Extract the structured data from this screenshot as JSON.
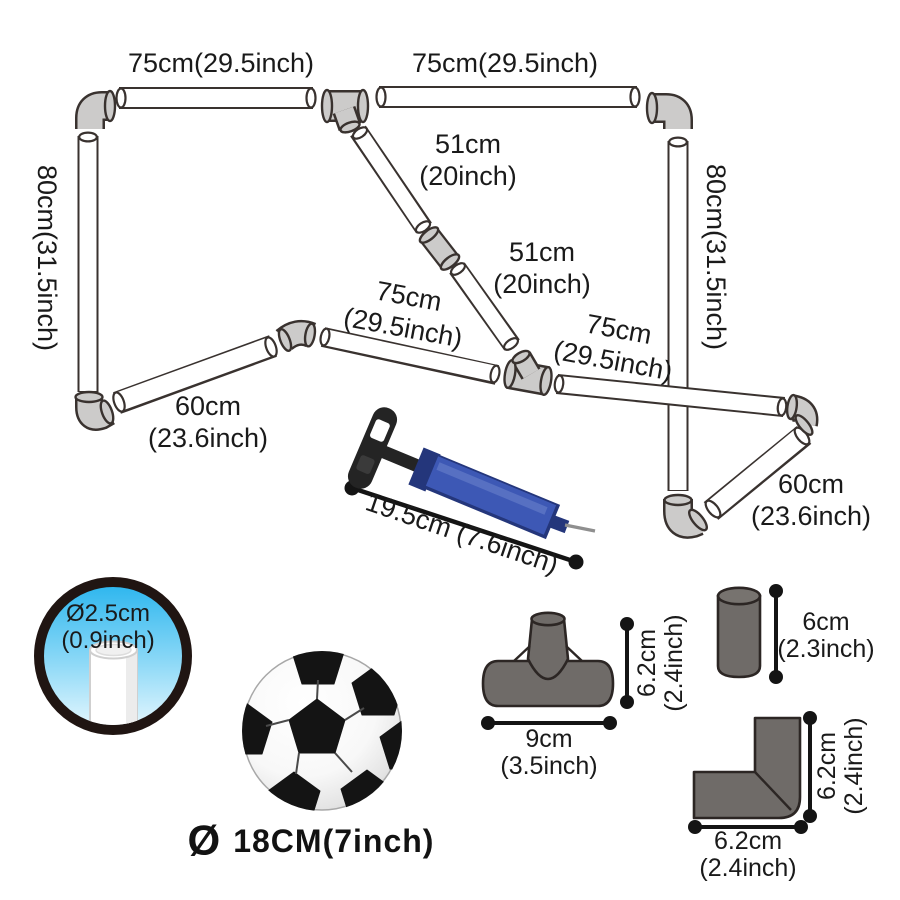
{
  "colors": {
    "pipe_outline": "#39322f",
    "pipe_fill": "#ffffff",
    "frame_connector_gray": "#cccbca",
    "part_gray": "#6f6b68",
    "part_outline": "#2c2624",
    "pump_blue": "#3d58b5",
    "pump_dark_blue": "#24367b",
    "lens_blue_top": "#2ab5ee",
    "lens_blue_bottom": "#e8f8fe",
    "dimension_black": "#141414"
  },
  "frame": {
    "crossbar_left": "75cm(29.5inch)",
    "crossbar_right": "75cm(29.5inch)",
    "post_left": "80cm(31.5inch)",
    "post_right": "80cm(31.5inch)",
    "diag_upper_line1": "51cm",
    "diag_upper_line2": "(20inch)",
    "diag_lower_line1": "51cm",
    "diag_lower_line2": "(20inch)",
    "base_left_line1": "75cm",
    "base_left_line2": "(29.5inch)",
    "base_right_line1": "75cm",
    "base_right_line2": "(29.5inch)",
    "ground_left_line1": "60cm",
    "ground_left_line2": "(23.6inch)",
    "ground_right_line1": "60cm",
    "ground_right_line2": "(23.6inch)"
  },
  "pump": {
    "length": "19.5cm (7.6inch)"
  },
  "tube": {
    "line1": "Ø2.5cm",
    "line2": "(0.9inch)"
  },
  "ball": {
    "symbol": "Ø",
    "label": "18CM(7inch)"
  },
  "tee": {
    "height_line1": "6.2cm",
    "height_line2": "(2.4inch)",
    "width_line1": "9cm",
    "width_line2": "(3.5inch)"
  },
  "coupler": {
    "height_line1": "6cm",
    "height_line2": "(2.3inch)"
  },
  "elbow": {
    "height_line1": "6.2cm",
    "height_line2": "(2.4inch)",
    "width_line1": "6.2cm",
    "width_line2": "(2.4inch)"
  }
}
